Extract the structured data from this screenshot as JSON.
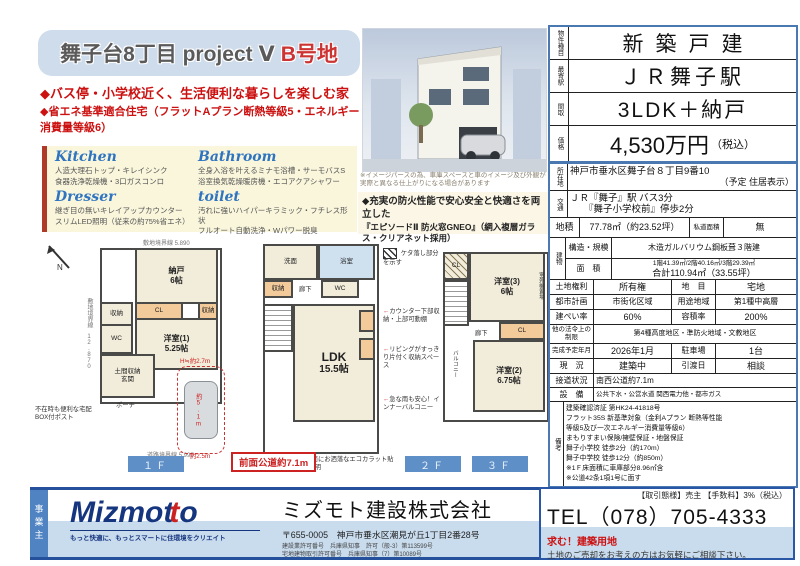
{
  "title": {
    "main": "舞子台8丁目 project Ⅴ",
    "badge": "B号地"
  },
  "bullets": {
    "line1": "◆バス停・小学校近く、生活便利な暮らしを楽しむ家",
    "line2": "◆省エネ基準適合住宅（フラットAプラン断熱等級5・エネルギー消費量等級6）"
  },
  "features": {
    "kitchen": {
      "heading": "Kitchen",
      "line1": "人造大理石トップ・キレイシンク",
      "line2": "食器洗浄乾燥機・3口ガスコンロ"
    },
    "bathroom": {
      "heading": "Bathroom",
      "line1": "全身入浴を叶えるミナモ浴槽・サーモバスS",
      "line2": "浴室換気乾燥暖房機・エコアクアシャワー"
    },
    "dresser": {
      "heading": "Dresser",
      "line1": "継ぎ目の無いキレイアップカウンター",
      "line2": "スリムLED照明（従来の約75%省エネ）"
    },
    "toilet": {
      "heading": "toilet",
      "line1": "汚れに強いハイパーキラミック・フチレス形状",
      "line2": "フルオート自動洗浄・Wパワー脱臭"
    }
  },
  "render": {
    "caption": "※イメージパースの為、車庫スペースと車のイメージ及び外観が実際と異なる仕上がりになる場合があります",
    "fire1": "◆充実の防火性能で安心安全と快適さを両立した",
    "fire2": "『エピソードⅡ 防火窓GNEO』（網入複層ガラス・クリアネット採用）"
  },
  "plans": {
    "boundary_top": "敷地境界線 5.890",
    "boundary_left": "敷地境界線 12.870",
    "boundary_bottom": "道路境界線 5.990",
    "road_box": "前面公道約7.1m",
    "compass": "N",
    "f1": {
      "tag": "１Ｆ",
      "nando": "納戸",
      "nando_size": "6帖",
      "cl": "CL",
      "shuno1": "収納",
      "shuno2": "収納",
      "wc": "WC",
      "roka": "廊下",
      "room": "洋室(1)",
      "room_size": "5.25帖",
      "genkan": "玄関",
      "doma": "土間収納",
      "porch": "ポーチ",
      "post": "不在時も便利な宅配BOX付ポスト",
      "car_h": "H≒約2.7m",
      "car_len": "約5.1m",
      "car_wid": "約2.5m"
    },
    "f2": {
      "tag": "２Ｆ",
      "senmen": "洗面",
      "bath": "浴室",
      "wc": "WC",
      "shuno": "収納",
      "roka": "廊下",
      "ldk": "LDK",
      "ldk_size": "15.5帖",
      "legend": "ケタ落し部分を示す",
      "note_counter": "カウンター下部収納・上部可動棚",
      "note_storage": "リビングがすっきり片付く収納スペース",
      "note_balcony": "急な雨も安心！インナーバルコニー",
      "note_wall": "リビング壁面にお洒落なエコカラット貼＋上部間接照明"
    },
    "f3": {
      "tag": "３Ｆ",
      "cl1": "CL",
      "room3": "洋室(3)",
      "room3_size": "6帖",
      "gaiki": "室外機置場",
      "roka": "廊下",
      "cl2": "CL",
      "room2": "洋室(2)",
      "room2_size": "6.75帖",
      "balcony": "バルコニー"
    }
  },
  "spec": {
    "type": {
      "label": "物件種目",
      "value": "新築戸建"
    },
    "station": {
      "label": "最寄駅",
      "value": "ＪＲ舞子駅"
    },
    "layout": {
      "label": "間取",
      "value": "3LDK＋納戸"
    },
    "price": {
      "label": "価格",
      "value": "4,530万円",
      "note": "（税込）"
    },
    "address": {
      "label": "所在地",
      "line1": "神戸市垂水区舞子台８丁目9番10",
      "line2": "（予定 住居表示）"
    },
    "access": {
      "label": "交通",
      "line1": "ＪＲ『舞子』駅 バス3分",
      "line2": "『舞子小学校前』停歩2分"
    },
    "land": {
      "label": "地積",
      "value": "77.78㎡（約23.52坪）",
      "label2": "私道面積",
      "value2": "無"
    },
    "building": {
      "label": "建物",
      "structure_label": "構造・規模",
      "structure": "木造ガルバリウム鋼板葺３階建",
      "area_label": "面　積",
      "area1": "1階41.39㎡/2階40.16㎡/3階29.39㎡",
      "area2": "合計110.94㎡（33.55坪）"
    },
    "right": {
      "label": "土地権利",
      "value": "所有権",
      "label2": "地　目",
      "value2": "宅地"
    },
    "plan": {
      "label": "都市計画",
      "value": "市街化区域",
      "label2": "用途地域",
      "value2": "第1種中高層"
    },
    "ratio": {
      "label": "建ぺい率",
      "value": "60%",
      "label2": "容積率",
      "value2": "200%"
    },
    "law": {
      "label": "他の法令上の制限",
      "value": "第4種高度地区・準防火地域・文教地区"
    },
    "completion": {
      "label": "完成予定年月",
      "value": "2026年1月",
      "label2": "駐車場",
      "value2": "1台"
    },
    "status": {
      "label": "現　況",
      "value": "建築中",
      "label2": "引渡日",
      "value2": "相談"
    },
    "road": {
      "label": "接道状況",
      "value": "南西公道約7.1m"
    },
    "utility": {
      "label": "設　備",
      "value": "公共下水・公営水道 関西電力他・都市ガス"
    },
    "notes": {
      "label": "備考",
      "lines": [
        "建築確認済証 第HK24-41818号",
        "フラット35S 新基準対象（金利Aプラン 断熱等性能",
        "等級5及び一次エネルギー消費量等級6）",
        "まもりすまい保険/擁壁保証・地盤保証",
        "舞子小学校 徒歩2分（約170m）",
        "舞子中学校 徒歩12分（約850m）",
        "※1Ｆ床面積に車庫部分8.96㎡含",
        "※公道42条1項1号に面す"
      ]
    }
  },
  "footer": {
    "owner_tab": "事業主",
    "logo_a": "Mizmot",
    "logo_b": "t",
    "logo_c": "o",
    "tagline": "もっと快適に、もっとスマートに住環境をクリエイト",
    "company": "ミズモト建設株式会社",
    "address": "〒655-0005　神戸市垂水区潮見が丘1丁目2番28号",
    "license1": "建設業許可番号　兵庫県知事　許可（般-3）第113599号",
    "license2": "宅地建物取引許可番号　兵庫県知事（7）第10089号",
    "deal": "【取引態様】売主 【手数料】3%（税込）",
    "tel": "TEL（078）705-4333",
    "recruit": "求む！建築用地",
    "recruit_sub": "土地のご売却をお考えの方はお気軽にご相談下さい。"
  }
}
